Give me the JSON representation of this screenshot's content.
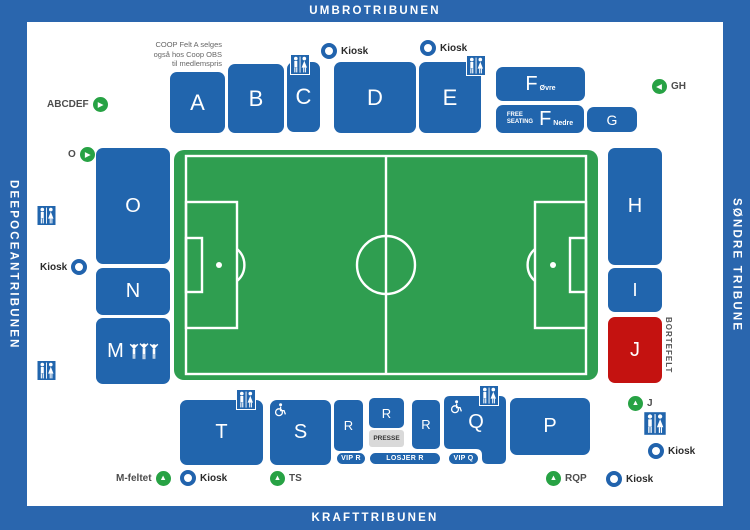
{
  "colors": {
    "frame_blue": "#2a66ae",
    "section_blue": "#2165ad",
    "away_red": "#c41210",
    "pitch_green": "#2f9e50",
    "arrow_green": "#27a244",
    "presse_gray": "#d9d9d9"
  },
  "tribunes": {
    "top": "UMBROTRIBUNEN",
    "bottom": "KRAFTTRIBUNEN",
    "left": "DEEPOCEANTRIBUNEN",
    "right": "SØNDRE TRIBUNE"
  },
  "coop_note": {
    "line1": "COOP Felt A selges",
    "line2": "også hos Coop OBS",
    "line3": "til medlemspris"
  },
  "sections": {
    "a": "A",
    "b": "B",
    "c": "C",
    "d": "D",
    "e": "E",
    "f_ovre_main": "F",
    "f_ovre_sub": "Øvre",
    "free_seating_line1": "FREE",
    "free_seating_line2": "SEATING",
    "f_nedre_main": "F",
    "f_nedre_sub": "Nedre",
    "g": "G",
    "h": "H",
    "i": "I",
    "j": "J",
    "o": "O",
    "n": "N",
    "m": "M",
    "t": "T",
    "s": "S",
    "r1": "R",
    "r2": "R",
    "r3": "R",
    "q": "Q",
    "p": "P"
  },
  "badges": {
    "vip_r": "VIP R",
    "losjer_r": "LOSJER R",
    "vip_q": "VIP Q",
    "presse": "PRESSE"
  },
  "labels": {
    "kiosk": "Kiosk",
    "abcdef": "ABCDEF",
    "o": "O",
    "gh": "GH",
    "j": "J",
    "m_feltet": "M-feltet",
    "ts": "TS",
    "rqp": "RQP",
    "bortefelt": "BORTEFELT"
  }
}
